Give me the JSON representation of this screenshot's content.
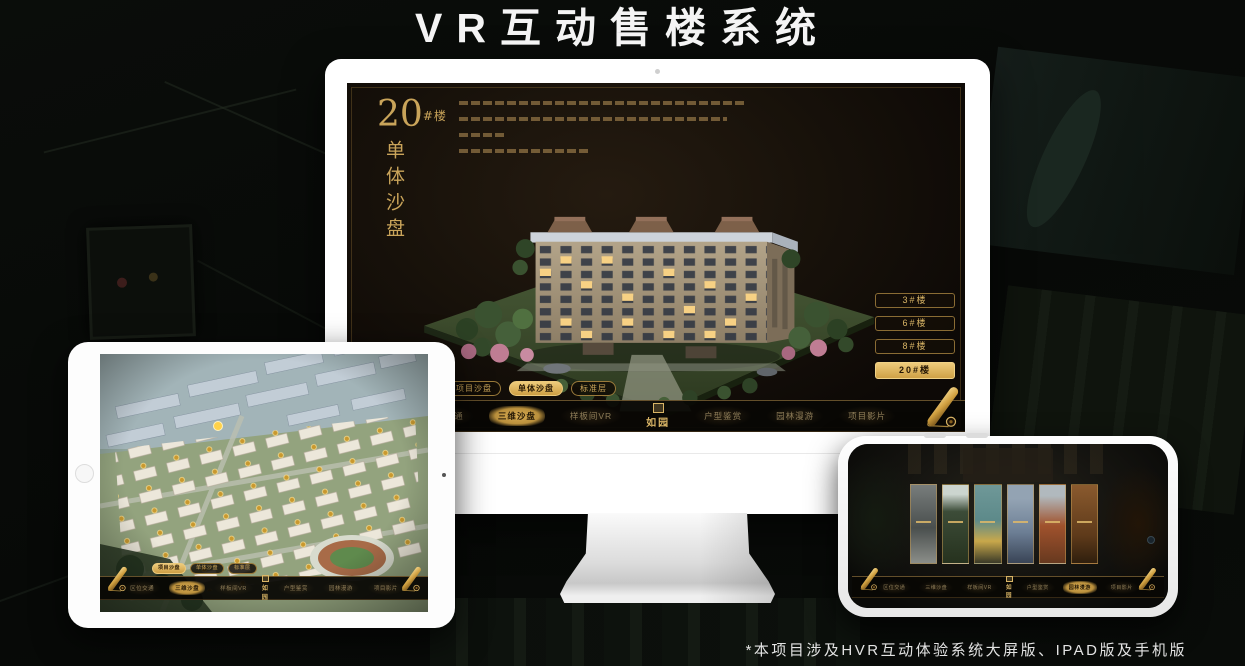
{
  "title": "VR互动售楼系统",
  "footnote": "*本项目涉及HVR互动体验系统大屏版、IPAD版及手机版",
  "brand": {
    "logo": "如园"
  },
  "nav": {
    "left": [
      {
        "label": "区位交通"
      },
      {
        "label": "三维沙盘"
      },
      {
        "label": "样板间VR"
      }
    ],
    "right": [
      {
        "label": "户型鉴赏"
      },
      {
        "label": "园林漫游"
      },
      {
        "label": "项目影片"
      }
    ]
  },
  "sub_tabs": [
    {
      "label": "项目沙盘"
    },
    {
      "label": "单体沙盘"
    },
    {
      "label": "标准层"
    }
  ],
  "monitor": {
    "heading_number": "20",
    "heading_unit": "#楼",
    "heading_vertical": "单体沙盘",
    "floor_buttons": [
      {
        "label": "3#楼"
      },
      {
        "label": "6#楼"
      },
      {
        "label": "8#楼"
      },
      {
        "label": "20#楼"
      }
    ],
    "active_floor": "20#楼",
    "active_sub_tab": "单体沙盘",
    "active_nav": "三维沙盘"
  },
  "tablet": {
    "active_sub_tab": "项目沙盘",
    "active_nav": "三维沙盘"
  },
  "phone": {
    "active_nav": "园林漫游"
  },
  "colors": {
    "gold": "#d9b566",
    "gold_bright": "#eecb7b",
    "screen_brown": "#1b140c",
    "device_white": "#ffffff"
  }
}
